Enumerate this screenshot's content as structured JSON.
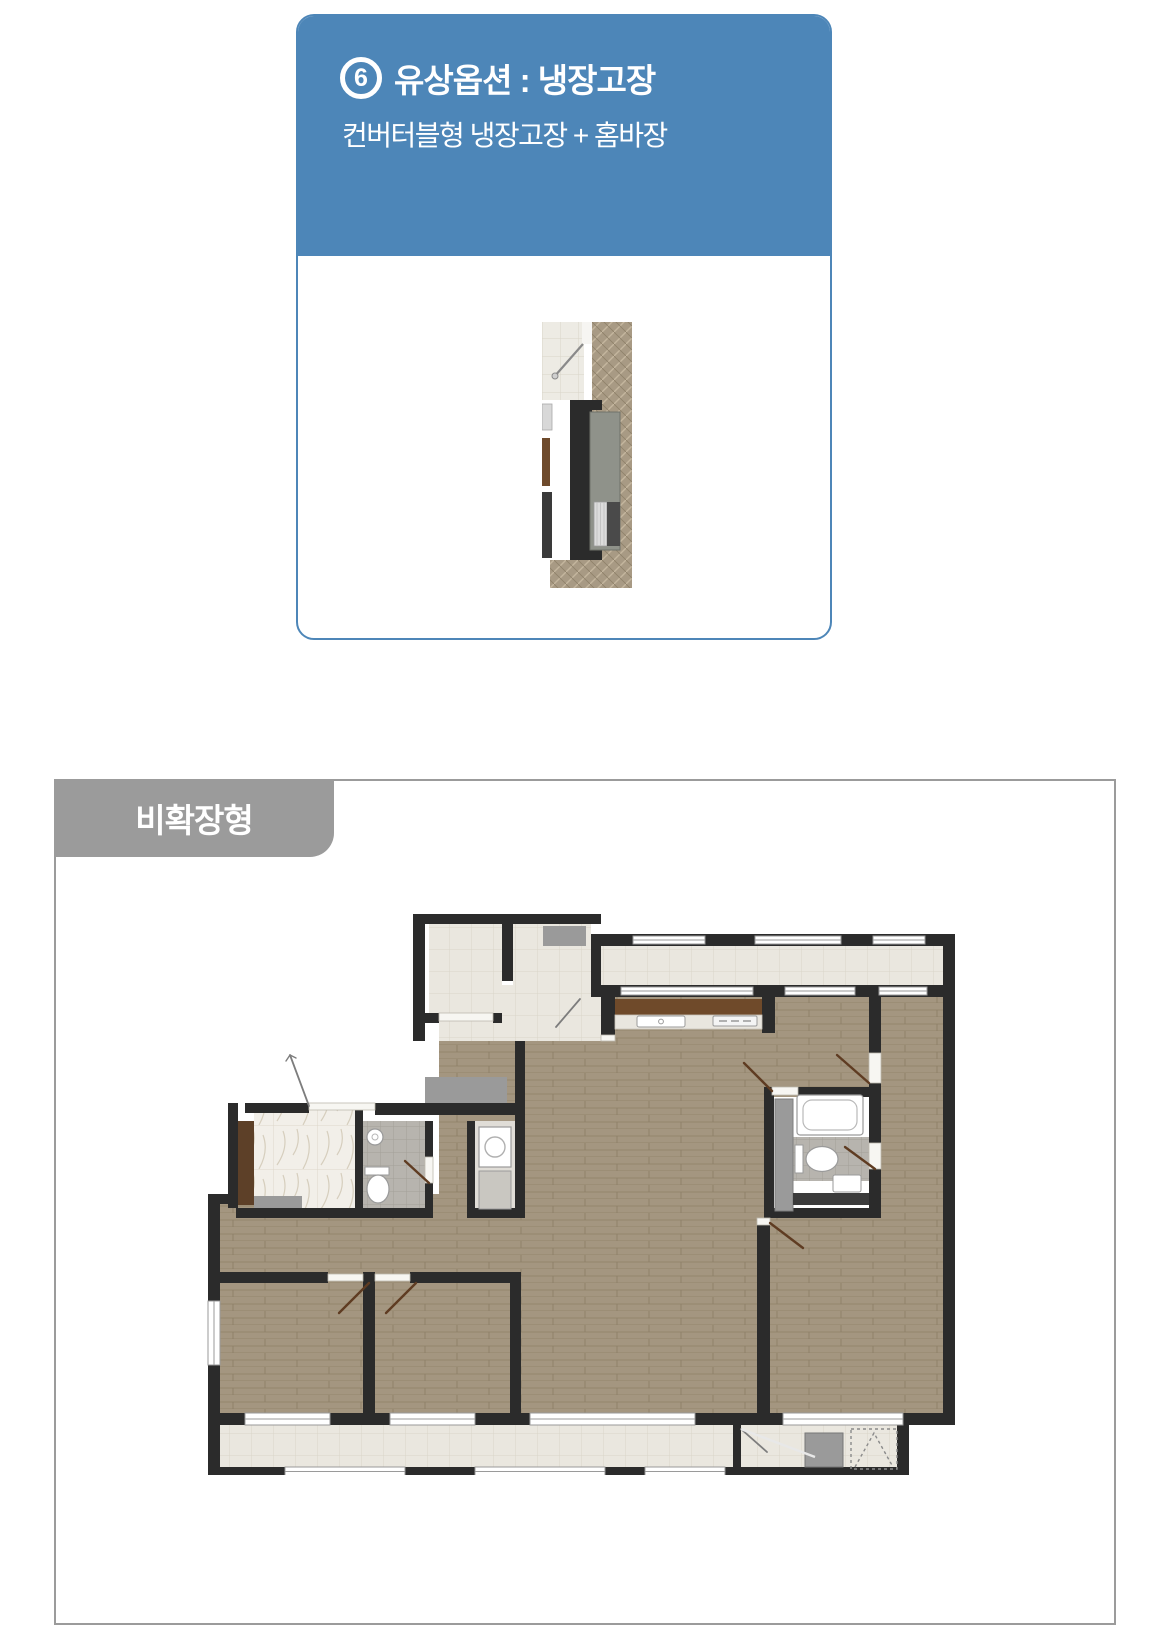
{
  "option_card": {
    "badge": "6",
    "title": "유상옵션 : 냉장고장",
    "subtitle": "컨버터블형 냉장고장 + 홈바장",
    "header_bg": "#4d86b8",
    "border_color": "#4d86b8",
    "text_color": "#ffffff"
  },
  "plan_panel": {
    "label": "비확장형",
    "label_bg": "#9b9b9b",
    "label_color": "#ffffff",
    "border_color": "#9b9b9b"
  },
  "floorplan_colors": {
    "wall": "#2b2b2b",
    "wood_floor": "#a49680",
    "tile_floor": "#eae7df",
    "bath_tile": "#b7b4ae",
    "marble": "#f2efe9",
    "laundry_floor": "#e0ddd7",
    "counter_wood": "#6f4a2a",
    "cabinet_gray": "#9a9a9a",
    "cabinet_brown": "#5d4028",
    "fixture_white": "#ffffff",
    "door_leaf": "#5f3c22"
  }
}
